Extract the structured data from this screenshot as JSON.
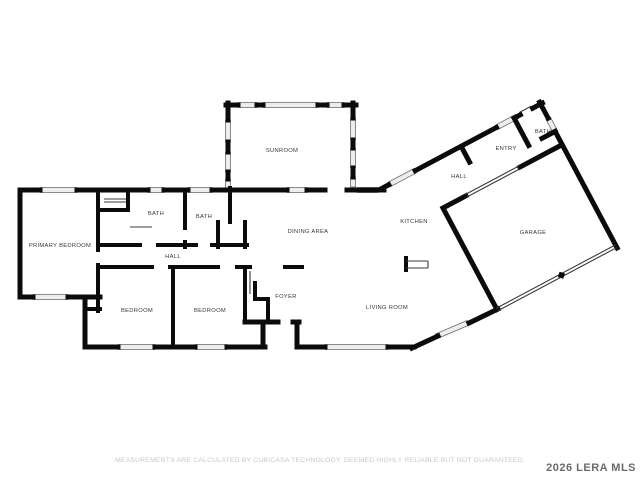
{
  "floor_plan": {
    "room_labels": [
      "SUNROOM",
      "PRIMARY BEDROOM",
      "BATH",
      "BATH",
      "HALL",
      "DINING AREA",
      "KITCHEN",
      "HALL",
      "ENTRY",
      "BATH",
      "GARAGE",
      "BEDROOM",
      "BEDROOM",
      "FOYER",
      "LIVING ROOM"
    ]
  },
  "footer": {
    "disclaimer": "MEASUREMENTS ARE CALCULATED BY CUBICASA TECHNOLOGY. DEEMED HIGHLY RELIABLE BUT NOT GUARANTEED."
  },
  "watermark": "2026 LERA MLS",
  "colors": {
    "wall": "#0b0b0b",
    "window_fill": "#ededed",
    "window_stroke": "#6f6f6f",
    "room_label": "#383838",
    "disclaimer_text": "#c8c8c8",
    "watermark_text": "#6b6b6b",
    "background": "#ffffff"
  }
}
